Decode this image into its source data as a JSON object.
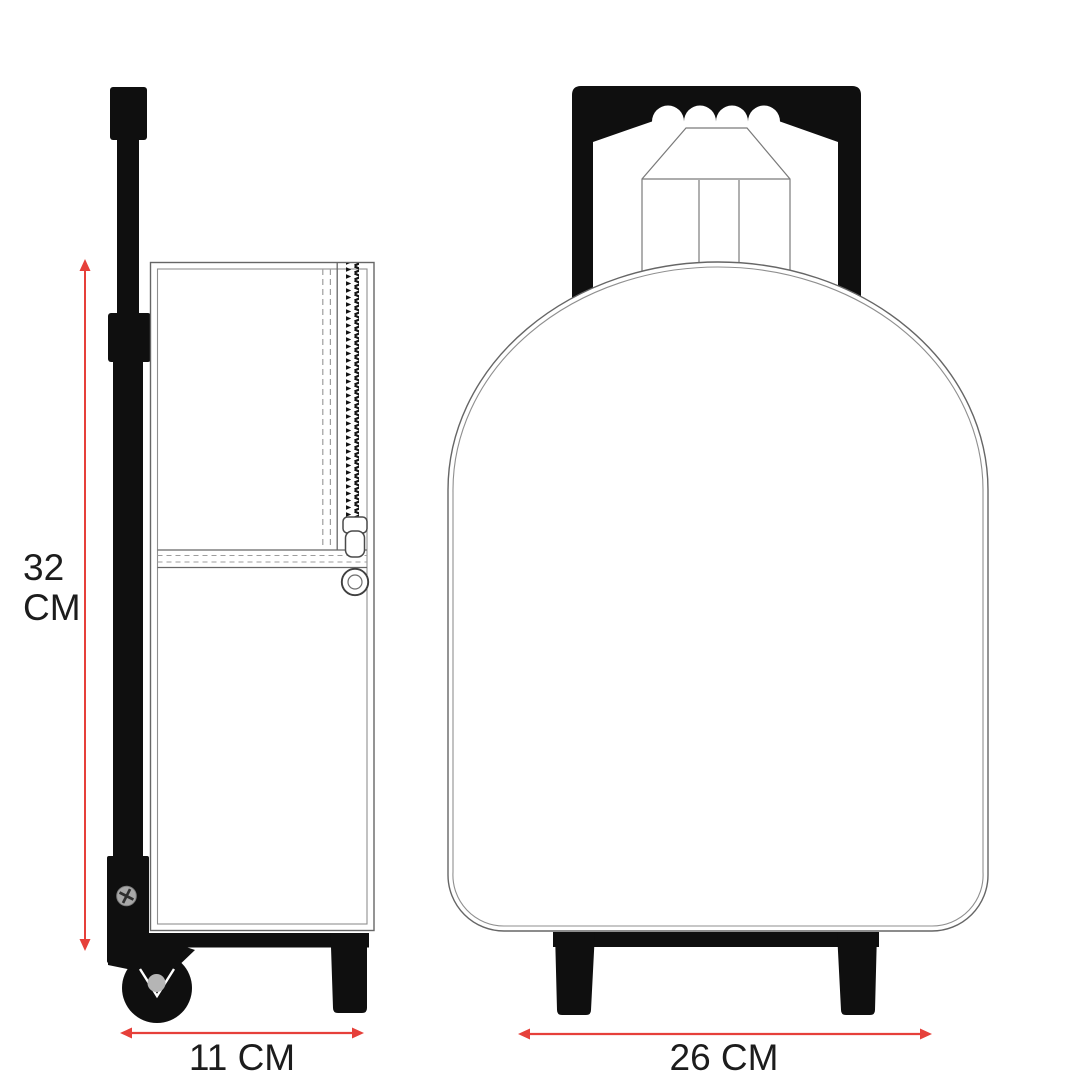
{
  "diagram": {
    "subject": "trolley backpack dimension drawing",
    "views": {
      "side": "side-view",
      "front": "front-view"
    }
  },
  "labels": {
    "height": {
      "line1": "32",
      "line2": "CM"
    },
    "depth": "11 CM",
    "width": "26 CM"
  },
  "colors": {
    "background": "#ffffff",
    "black": "#0f0f0f",
    "line_gray": "#666666",
    "inner_line_gray": "#8f8f8f",
    "dash_gray": "#9d9d9d",
    "red": "#e6403a",
    "screw_gray": "#a8a8a8",
    "axle_gray": "#b5b5b5",
    "text": "#1c1c1c"
  }
}
